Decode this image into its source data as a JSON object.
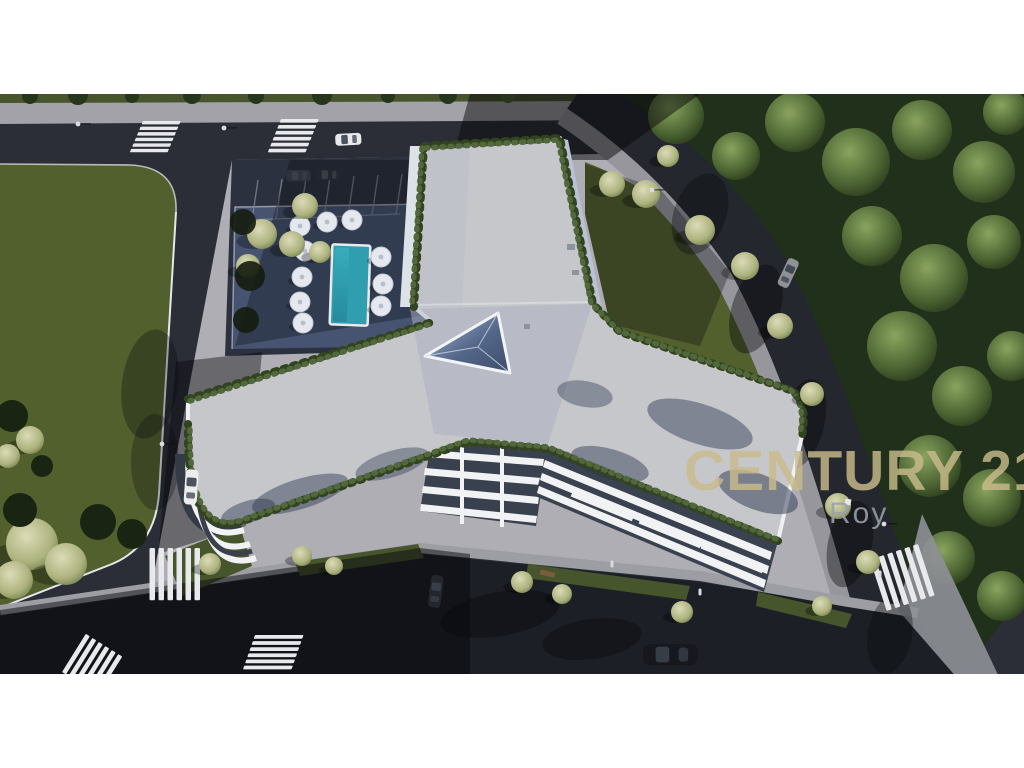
{
  "watermark": {
    "brand_text": "CENTURY 21",
    "agent_text": "Roy",
    "brand_color": "#c9bb8c",
    "agent_color": "#9aa1a9"
  },
  "scene": {
    "description": "Aerial 3D architectural rendering of a Y-shaped white apartment complex with flat gray roofs, perimeter rooftop hedges, a triangular glass skylight, swimming pool with white parasols, shaded pool deck, parking lot, surrounding asphalt streets with zebra crosswalks, a large lawn parcel on the left and dense tree canopy on the right",
    "frame_color": "#ffffff",
    "palette": {
      "asphalt": "#2b2e36",
      "asphalt_dark": "#1c1f26",
      "pavement": "#aeaeb4",
      "sidewalk": "#9d9ea4",
      "lawn": "#52602e",
      "lawn_dark": "#3b4823",
      "forest": "#20301a",
      "roof": "#c6c7cb",
      "roof_shade": "#aab0bf",
      "building": "#eef0f3",
      "hedge": "#52683c",
      "pool_water": "#2f9fb0",
      "pool_deck": "#475471",
      "umbrella": "#e5e8ee"
    },
    "features": [
      "Y-shaped white residential building",
      "triangular rooftop skylight",
      "rooftop perimeter hedges",
      "swimming pool with 10 white parasols",
      "shaded pool deck",
      "parking lot with marked stalls",
      "six zebra crosswalks",
      "green lawn parcel with trees",
      "dense forest canopy",
      "six cars",
      "street lamps",
      "paved plaza with planting strips"
    ],
    "vehicles": [
      {
        "color": "white",
        "location": "top road"
      },
      {
        "color": "dark",
        "location": "parking lot"
      },
      {
        "color": "dark",
        "location": "parking lot"
      },
      {
        "color": "white",
        "location": "left road"
      },
      {
        "color": "gray",
        "location": "right curving road"
      },
      {
        "color": "dark",
        "location": "west service road"
      },
      {
        "color": "dark",
        "location": "bottom road"
      }
    ]
  }
}
